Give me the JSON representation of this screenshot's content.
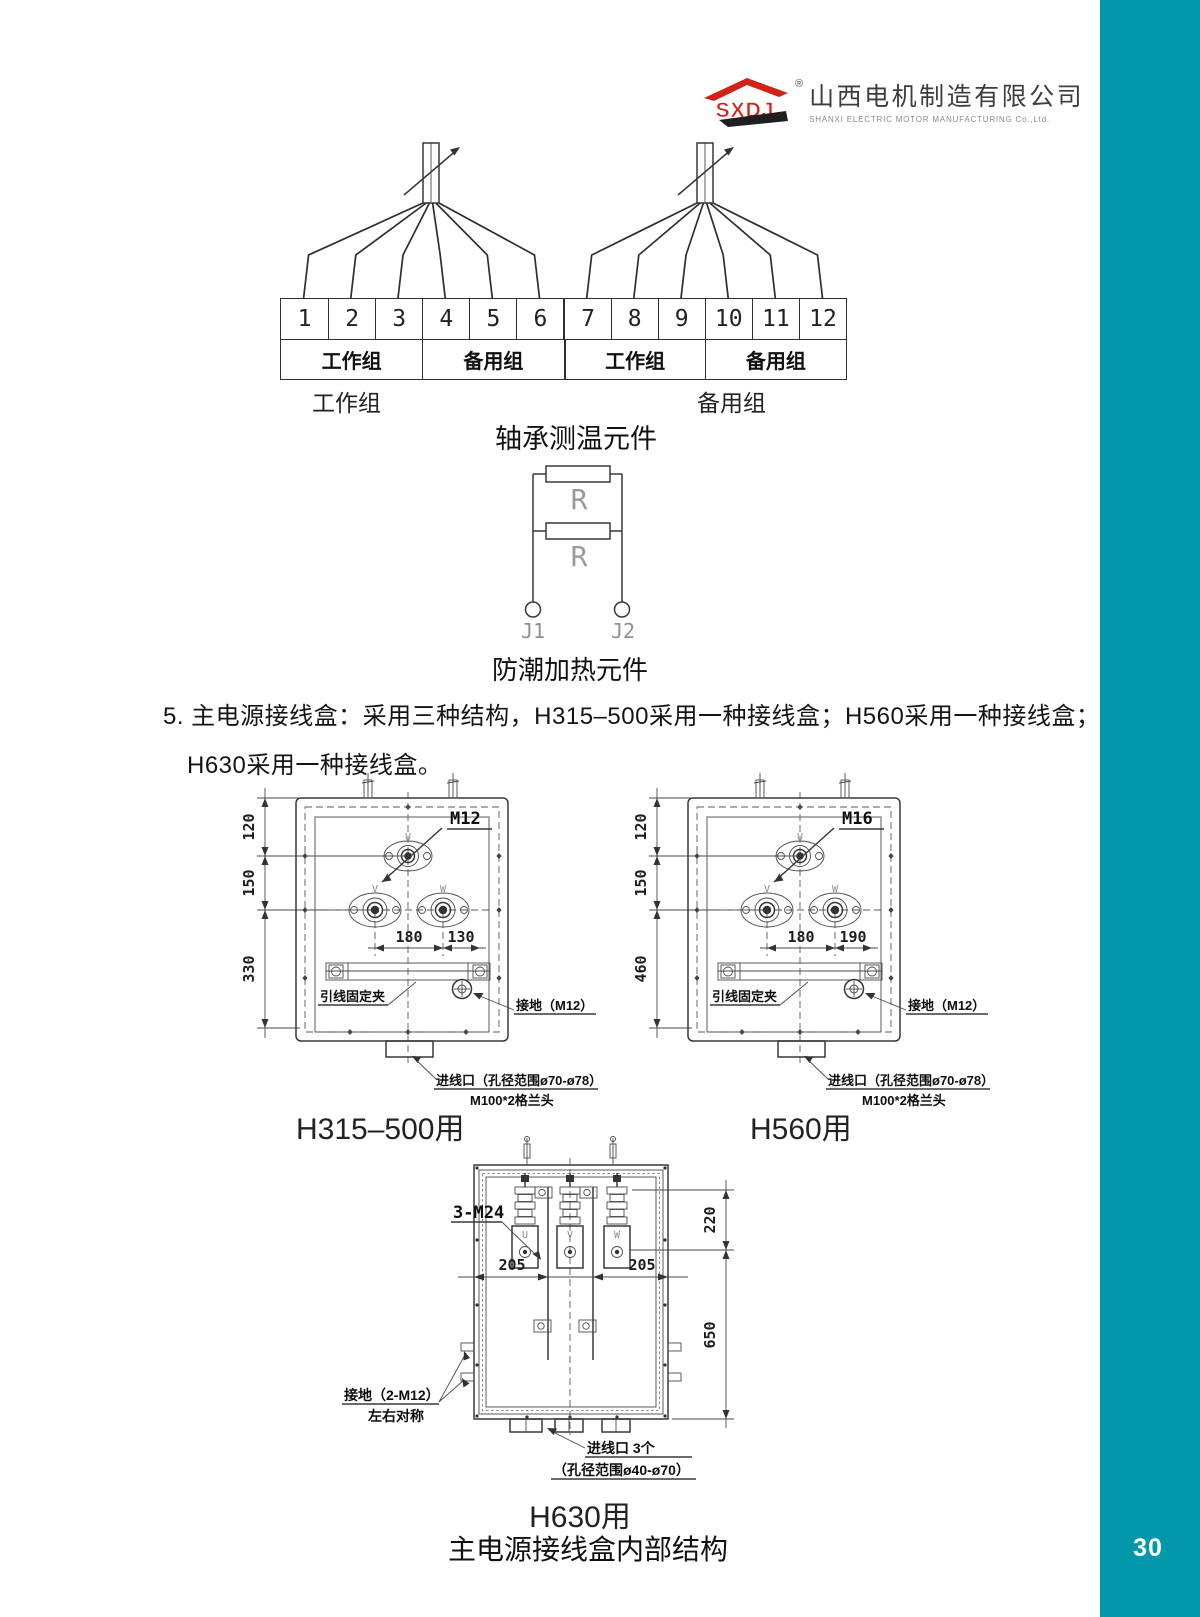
{
  "page": {
    "number": "30",
    "accent": "#0397AB"
  },
  "logo": {
    "mark": "SXDJ",
    "registered": "®",
    "company_cn": "山西电机制造有限公司",
    "company_en": "SHANXI ELECTRIC MOTOR MANUFACTURING Co.,Ltd."
  },
  "terminal_diagram": {
    "terminals": [
      "1",
      "2",
      "3",
      "4",
      "5",
      "6",
      "7",
      "8",
      "9",
      "10",
      "11",
      "12"
    ],
    "groups": [
      "工作组",
      "备用组",
      "工作组",
      "备用组"
    ],
    "left_label": "工作组",
    "right_label": "备用组",
    "caption": "轴承测温元件"
  },
  "heater_diagram": {
    "resistor1": "R",
    "resistor2": "R",
    "terminal1": "J1",
    "terminal2": "J2",
    "caption": "防潮加热元件"
  },
  "paragraph": {
    "line1": "5. 主电源接线盒：采用三种结构，H315–500采用一种接线盒；H560采用一种接线盒；",
    "line2": "H630采用一种接线盒。"
  },
  "box1": {
    "m_label": "M12",
    "u": "U",
    "v": "V",
    "w": "W",
    "dim_top": "120",
    "dim_mid": "150",
    "dim_bot": "330",
    "dim_w1": "180",
    "dim_w2": "130",
    "clamp": "引线固定夹",
    "ground": "接地（M12）",
    "entry1": "进线口（孔径范围ø70-ø78）",
    "entry2": "M100*2格兰头",
    "caption": "H315–500用"
  },
  "box2": {
    "m_label": "M16",
    "u": "U",
    "v": "V",
    "w": "W",
    "dim_top": "120",
    "dim_mid": "150",
    "dim_bot": "460",
    "dim_w1": "180",
    "dim_w2": "190",
    "clamp": "引线固定夹",
    "ground": "接地（M12）",
    "entry1": "进线口（孔径范围ø70-ø78）",
    "entry2": "M100*2格兰头",
    "caption": "H560用"
  },
  "box3": {
    "bolt": "3-M24",
    "u": "U",
    "v": "V",
    "w": "W",
    "dim_w1": "205",
    "dim_w2": "205",
    "dim_r1": "220",
    "dim_r2": "650",
    "ground1": "接地（2-M12）",
    "ground2": "左右对称",
    "entry1": "进线口 3个",
    "entry2": "（孔径范围ø40-ø70）",
    "caption": "H630用"
  },
  "footer_caption": "主电源接线盒内部结构"
}
